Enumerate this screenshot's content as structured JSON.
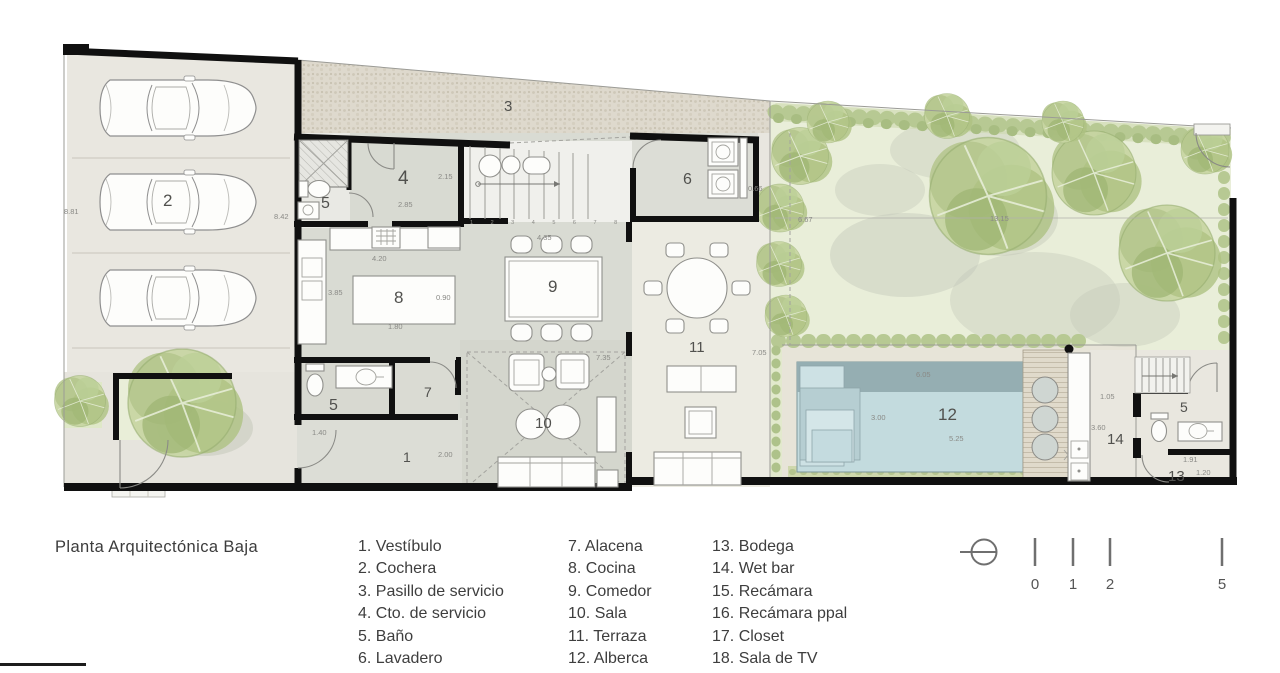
{
  "legend": {
    "title": "Planta Arquitectónica Baja",
    "col1": [
      "1. Vestíbulo",
      "2. Cochera",
      "3. Pasillo de servicio",
      "4. Cto. de servicio",
      "5. Baño",
      "6. Lavadero"
    ],
    "col2": [
      "7. Alacena",
      "8. Cocina",
      "9. Comedor",
      "10. Sala",
      "11. Terraza",
      "12. Alberca"
    ],
    "col3": [
      "13. Bodega",
      "14. Wet bar",
      "15. Recámara",
      "16. Recámara ppal",
      "17. Closet",
      "18. Sala de TV"
    ]
  },
  "scale_bar": {
    "ticks": [
      "0",
      "1",
      "2",
      "5"
    ]
  },
  "plan": {
    "rooms": {
      "vestibulo": "1",
      "cochera": "2",
      "pasillo": "3",
      "cto_servicio": "4",
      "bano_garage": "5",
      "bano_main": "5",
      "bano_right": "5",
      "lavadero": "6",
      "alacena": "7",
      "cocina": "8",
      "comedor": "9",
      "sala": "10",
      "terraza": "11",
      "alberca": "12",
      "bodega": "13",
      "wetbar": "14"
    },
    "dims": {
      "garage_left": "8.81",
      "garage_right": "8.42",
      "cto_w": "2.15",
      "cto_h": "2.85",
      "comedor_w": "4.35",
      "cocina_w": "4.20",
      "cocina_h": "3.85",
      "isla_w": "0.90",
      "isla_l": "1.80",
      "lavadero_d": "0.66",
      "jardin_w": "6.67",
      "jardin_l": "13.15",
      "terraza_h": "7.05",
      "sala_h": "7.35",
      "vest_w": "1.40",
      "vest_h": "2.00",
      "pool_w": "6.05",
      "pool_h": "3.00",
      "pool_l": "5.25",
      "wetbar_w": "1.05",
      "wetbar_h": "3.60",
      "bodega_w": "1.91",
      "bodega_h": "1.20",
      "stair_steps": "1 2 3 4 5 6 7 8"
    }
  },
  "colors": {
    "wall": "#101010",
    "interior_floor": "#d9dbd3",
    "terraza_floor": "#ecebe2",
    "garage_floor": "#e9e7e0",
    "gravel": "#ded9cd",
    "garden": "#e9eed9",
    "tree_green": "#b2c488",
    "pool_water": "#c3dbde",
    "pool_dark": "#95aeb2",
    "legend_text": "#3e3e3e",
    "dim_text": "#8a8a86"
  }
}
